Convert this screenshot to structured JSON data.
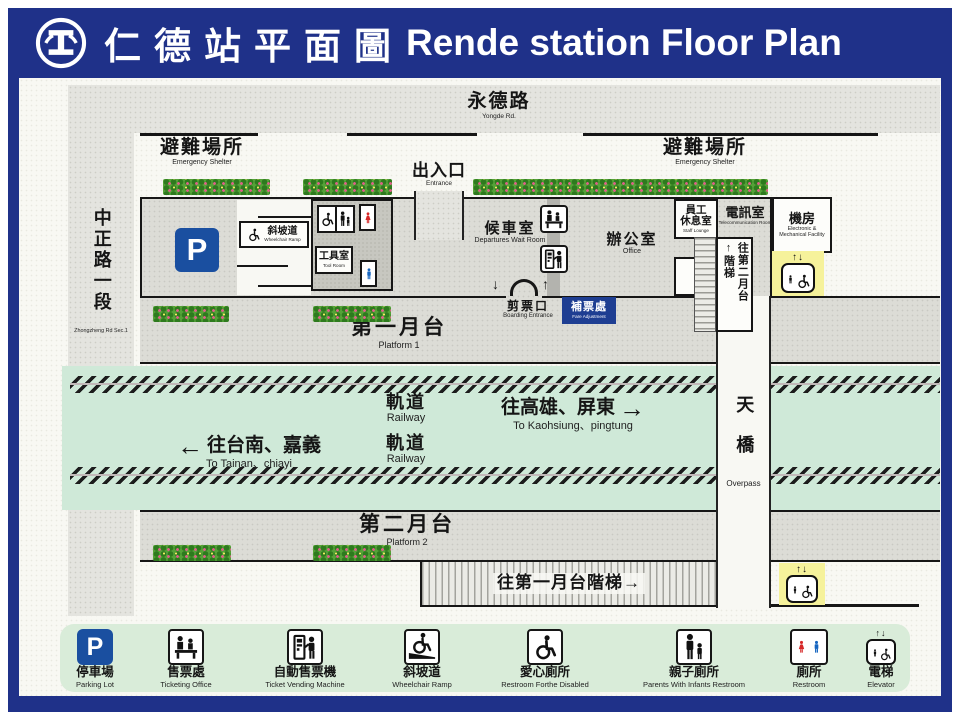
{
  "header": {
    "title_zh": "仁德站平面圖",
    "title_en": "Rende station Floor Plan"
  },
  "roads": {
    "top_zh": "永德路",
    "top_en": "Yongde Rd.",
    "left_zh": "中正路一段",
    "left_en": "Zhongzheng Rd Sec.1"
  },
  "station": {
    "shelter_zh": "避難場所",
    "shelter_en": "Emergency Shelter",
    "entrance_zh": "出入口",
    "entrance_en": "Entrance",
    "parking_p": "P",
    "ramp_zh": "斜坡道",
    "ramp_en": "Wheelchair Ramp",
    "tool_zh": "工具室",
    "tool_en": "Tool Room",
    "wait_zh": "候車室",
    "wait_en": "Departures Wait Room",
    "office_zh": "辦公室",
    "office_en": "Office",
    "lounge_zh_line1": "員工",
    "lounge_zh_line2": "休息室",
    "lounge_en": "Staff Lounge",
    "telecom_zh": "電訊室",
    "telecom_en": "Telecommunication Room",
    "machine_zh": "機房",
    "machine_en": "Electronic & Mechanical Facility",
    "stairs_arrow": "↑",
    "stairs_zh": "階梯",
    "stairs_dest_zh": "往第二月台",
    "boarding_zh": "剪票口",
    "boarding_en": "Boarding Entrance",
    "boarding_down": "↓",
    "boarding_up": "↑",
    "fare_zh": "補票處",
    "fare_en": "Fare Adjustment",
    "platform1_zh": "第一月台",
    "platform1_en": "Platform 1",
    "platform2_zh": "第二月台",
    "platform2_en": "Platform 2",
    "railway_zh": "軌道",
    "railway_en": "Railway",
    "dir_right_zh": "往高雄、屏東",
    "dir_right_arrow": "→",
    "dir_right_en": "To Kaohsiung、pingtung",
    "dir_left_arrow": "←",
    "dir_left_zh": "往台南、嘉義",
    "dir_left_en": "To Tainan、chiayi",
    "overpass_zh": "天橋",
    "overpass_en": "Overpass",
    "p1_stairs_zh": "往第一月台階梯→",
    "elev_arrows": "↑↓"
  },
  "legend": {
    "items": [
      {
        "zh": "停車場",
        "en": "Parking Lot"
      },
      {
        "zh": "售票處",
        "en": "Ticketing Office"
      },
      {
        "zh": "自動售票機",
        "en": "Ticket Vending Machine"
      },
      {
        "zh": "斜坡道",
        "en": "Wheelchair Ramp"
      },
      {
        "zh": "愛心廁所",
        "en": "Restroom Forthe Disabled"
      },
      {
        "zh": "親子廁所",
        "en": "Parents With Infants Restroom"
      },
      {
        "zh": "廁所",
        "en": "Restroom"
      },
      {
        "zh": "電梯",
        "en": "Elevator"
      }
    ]
  },
  "colors": {
    "navy": "#1f3189",
    "track_green": "#cfe9d8",
    "legend_green": "#d9ecd9",
    "parking_blue": "#1a4fa0",
    "elevator_yellow": "#f6f29b",
    "female_red": "#d62828",
    "male_blue": "#1565c0",
    "hedge_green": "#55a238",
    "fare_navy": "#1e3e92"
  }
}
